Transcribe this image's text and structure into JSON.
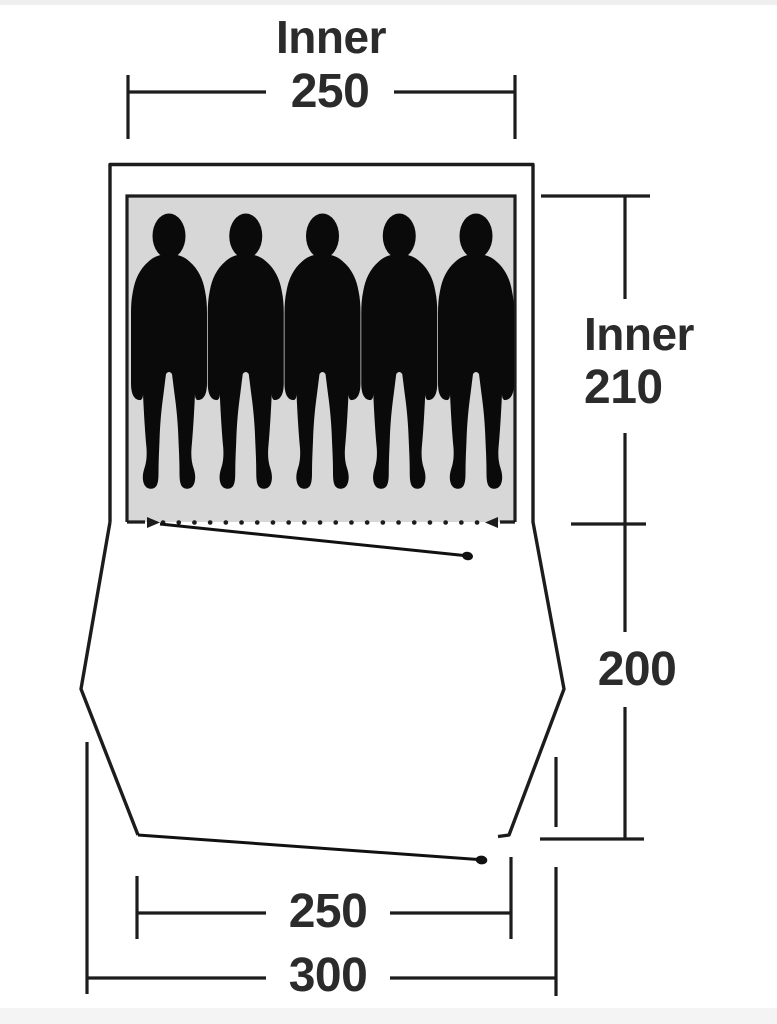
{
  "diagram": {
    "type": "tent-floorplan",
    "occupants": 5,
    "dims": {
      "inner_width": {
        "label": "Inner",
        "value": "250"
      },
      "inner_depth": {
        "label": "Inner",
        "value": "210"
      },
      "porch_depth": {
        "value": "200"
      },
      "front_inner_width": {
        "value": "250"
      },
      "outer_width": {
        "value": "300"
      }
    },
    "colors": {
      "outline": "#1c1c1c",
      "figure": "#0a0a0a",
      "inner_area_fill": "#d7d7d7",
      "text": "#2b2b2b",
      "background": "#ffffff"
    }
  }
}
